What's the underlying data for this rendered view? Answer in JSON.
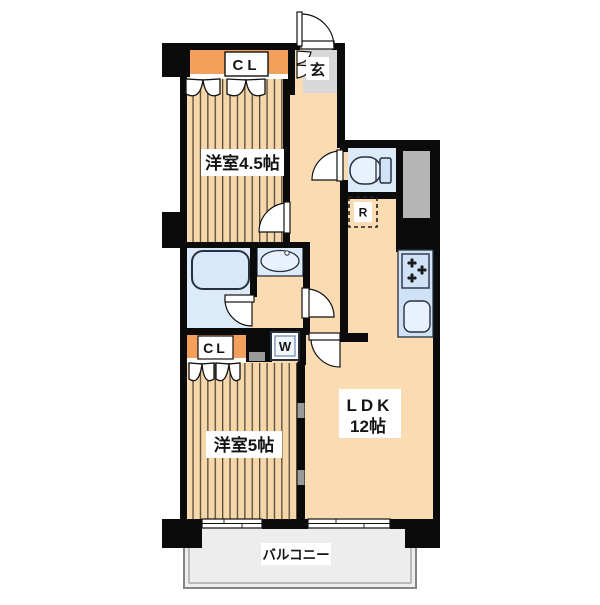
{
  "plan": {
    "type": "apartment-floor-plan",
    "labels": {
      "entrance": "玄",
      "closet_top": "CL",
      "room_4_5": "洋室4.5帖",
      "refrigerator": "R",
      "washing_machine": "W",
      "closet_bottom": "CL",
      "room_5": "洋室5帖",
      "ldk_name": "LDK",
      "ldk_size": "12帖",
      "balcony": "バルコニー"
    },
    "colors": {
      "wall": "#0b0b0b",
      "floor": "#fbdcb2",
      "stripe_floor": "#f6d7a9",
      "stripe_line": "#55493c",
      "closet_orange": "#f2a05c",
      "wet_blue": "#dcebfa",
      "kitchen_blue": "#cfe2f6",
      "fixture_fill": "#e9f2fc",
      "entrance_gray": "#d8d8d8",
      "duct_gray": "#b5b5b5",
      "balcony_gray": "#ededed"
    }
  }
}
